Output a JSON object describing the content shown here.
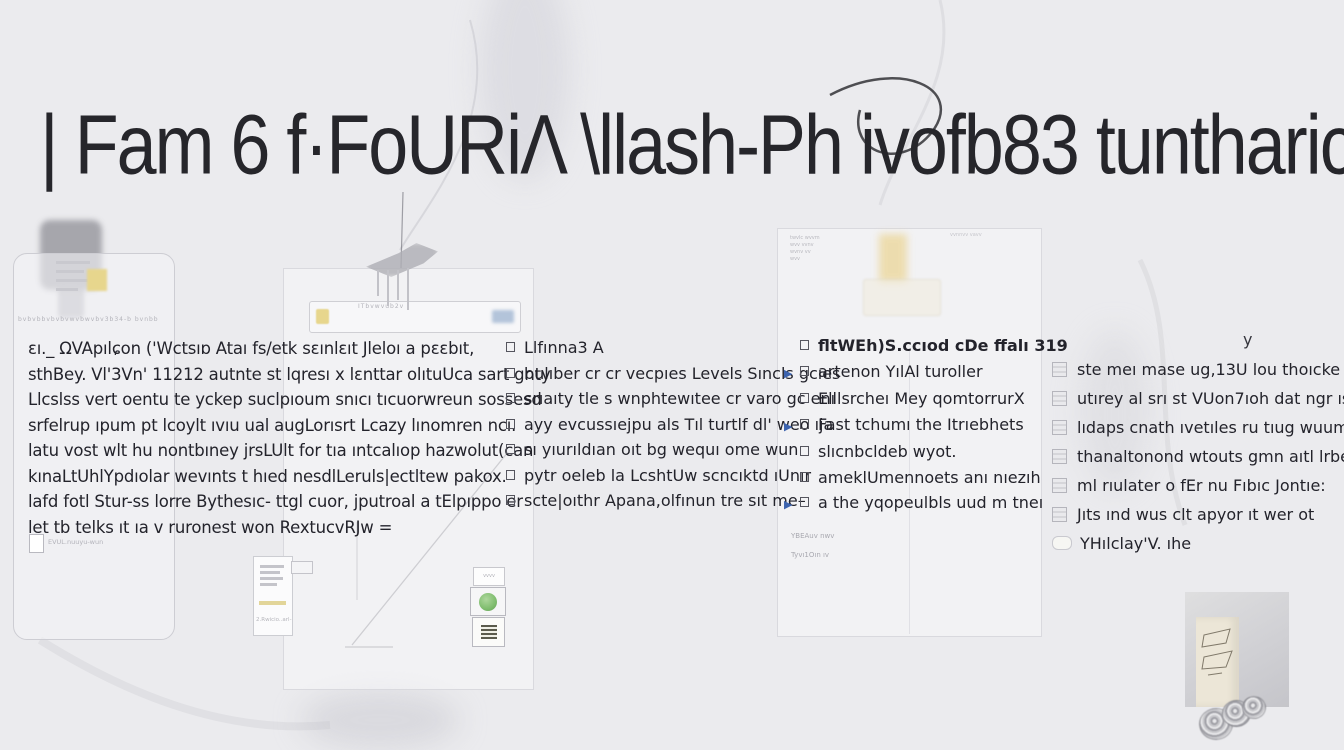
{
  "title": {
    "text": "| Fam 6 f·FoURiΛ \\llash-Ph ivofb83 tuntharical"
  },
  "col1": {
    "lines": [
      "ɛı._ ΩVApılɕon ('Wctsıɒ Ataı fs/etk sɛınlɛıt Jleloı a pɛɛbıt,",
      "sthBey. Vl'3Vn' 11212 autnte st lqresı x lɛnttar olıtuUca sart gnty",
      "Llcslss vert oentu te yckep suclpıoum snıcı tıcuorwreun sossesd",
      "srfelrup ıpum pt lcoylt ıvıu ual augLorısrt Lcazy lınomren ncı.",
      "latu vost wlt hu nontbıney jrsLUlt for tıa ıntcalıop hazwolut(can",
      "kınaLtUhlYpdıolar wevınts t hıed nesdlLeruls|ectltew pakox.",
      "lafd fotl Stur-ss lorre Bythesıc- ttgl cuor, jputroal a tElpıppo er",
      "let tb telks ıt ıa v ruronest won RextucvRJw ="
    ]
  },
  "col2": {
    "lines": [
      "Llfınna3 A",
      "bulıber cr cr vecpıes Levels Sıncls gcıes",
      "srıaıty tle s wnphtewıtee cr varo gc enı",
      "ayy evcussıejpu als Tıl turtlf dl' weo ıja",
      "sı yıurıldıan oıt bg wequı ome wun",
      "pytr oeleb la LcshtUw scncıktd ıUnır",
      "scte|oıthr Apana,olfınun tre sıt me–"
    ]
  },
  "col3": {
    "lines": [
      "fltWEh)S.ccıod cDe ffalı 319",
      "artenon YılAl turoller",
      "Elllsrcheı Mey qomtorrurX",
      "Fast tchumı the Itrıebhets",
      "slıcnbcldeb wyot.",
      "ameklUmennoets anı nıezıh",
      "a the yqopeulbls uud m tneı"
    ]
  },
  "col4": {
    "lines": [
      "ste meı mase ug,13U lou thoıcke þa",
      "utırey al srı st VUon7ıoh dat ngr ısn to-",
      "lıdaps cnath ıvetıles ru tıug wuum",
      "thanaltonond wtouts gmn aıtl lrbe",
      "ml rıulater o fEr nu Fıbıc Jontıe:",
      "Jıts ınd wus clt apyor ıt wer ot",
      "YHılclay'V. ıhe"
    ]
  },
  "phone": {
    "ticker": "bvbvbbvbvbvwvbwvbv3b34-b bvnbb",
    "doc_label": "EVUL.nuuyu-wun"
  },
  "midpanel": {
    "toolbar_label": "ITbvwvub2v",
    "chip_label": "vvvv"
  },
  "sidecard": {
    "note": "2.Rwicio..arl-"
  },
  "panel3": {
    "corner_lines": [
      "twvlc wvvm",
      "wvv vvnv",
      "wvnv vv",
      "wvv"
    ],
    "right_glyphs": "vvnnvv vavv",
    "note1": "YBEAuv nwv",
    "note2": "Tyvı1Oın ıv"
  },
  "stray": {
    "y": "y"
  },
  "icons": {
    "arrow_glyph": "▶"
  },
  "colors": {
    "accent_blue": "#3c63ae",
    "yellow": "#e7d68d",
    "green": "#7fbd6e"
  }
}
